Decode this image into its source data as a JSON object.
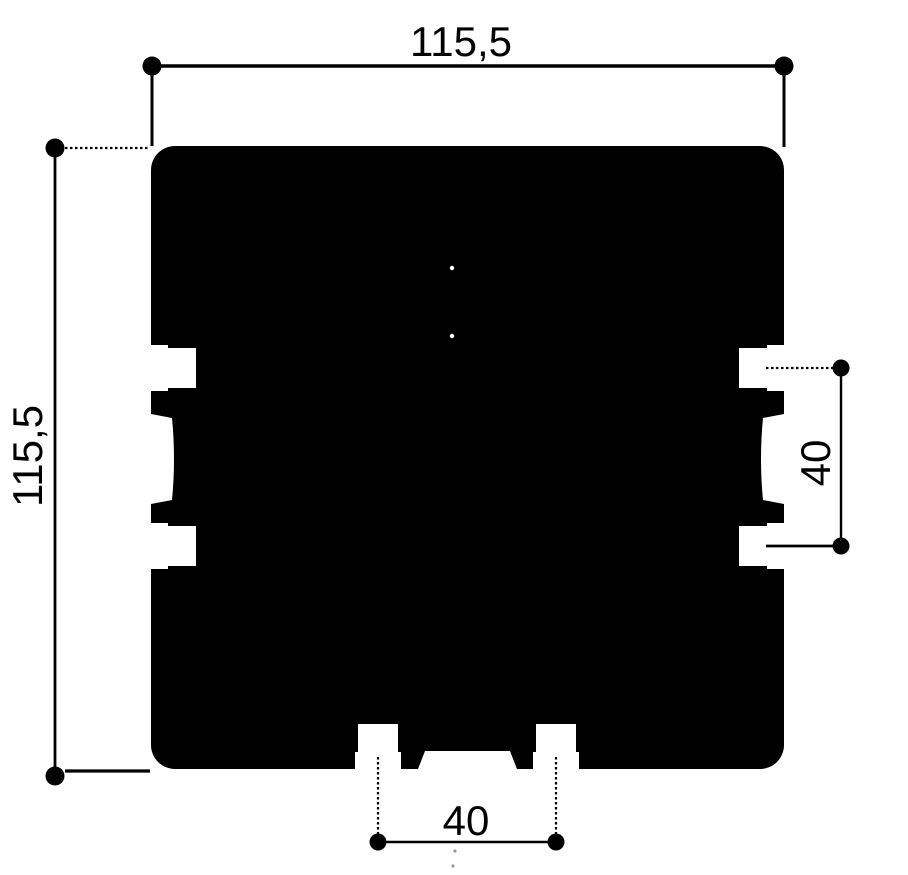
{
  "labels": {
    "top_width": "115,5",
    "left_height": "115,5",
    "right_slot_pitch": "40",
    "bottom_slot_pitch": "40"
  },
  "colors": {
    "ink": "#000000",
    "background": "#ffffff"
  }
}
